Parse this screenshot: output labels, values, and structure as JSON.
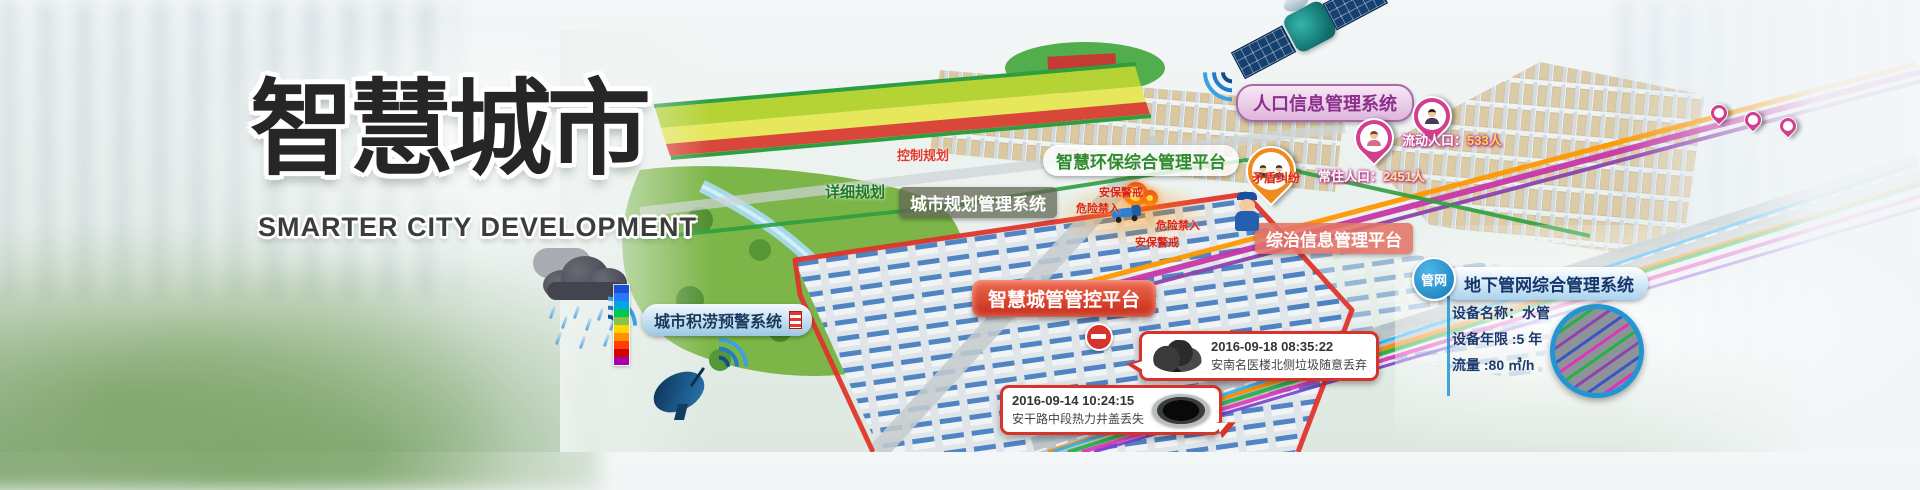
{
  "title": {
    "zh": "智慧城市",
    "en": "SMARTER CITY DEVELOPMENT"
  },
  "systems": {
    "waterlogging": "城市积涝预警系统",
    "planning": "城市规划管理系统",
    "environment": "智慧环保综合管理平台",
    "population": "人口信息管理系统",
    "governance": "综治信息管理平台",
    "city_mgmt": "智慧城管管控平台",
    "pipeline": "地下管网综合管理系统",
    "pipeline_badge": "管网"
  },
  "zones": {
    "control": "控制规划",
    "detail": "详细规划"
  },
  "population_info": {
    "floating_label": "流动人口：",
    "floating_value": "533人",
    "resident_label": "常住人口：",
    "resident_value": "2451人",
    "dispute": "矛盾纠纷"
  },
  "warnings": {
    "alert_top": "安保警戒",
    "danger_left": "危险禁入",
    "danger_right": "危险禁入",
    "alert_bottom": "安保警戒"
  },
  "pipeline_info": {
    "name": "设备名称：水管",
    "age": "设备年限 :5 年",
    "flow": "流量 :80 ㎥/h"
  },
  "events": [
    {
      "time": "2016-09-18 08:35:22",
      "desc": "安南名医楼北侧垃圾随意丢弃"
    },
    {
      "time": "2016-09-14 10:24:15",
      "desc": "安干路中段热力井盖丢失"
    }
  ],
  "colors": {
    "accent_red": "#d8332a",
    "pin_magenta": "#d23f8f",
    "pin_orange": "#f08a1d",
    "label_purple": "#8b2f8b",
    "label_green": "#2e8b2e",
    "label_navy": "#1a3a6b",
    "value_yellow": "#ffd84d"
  }
}
